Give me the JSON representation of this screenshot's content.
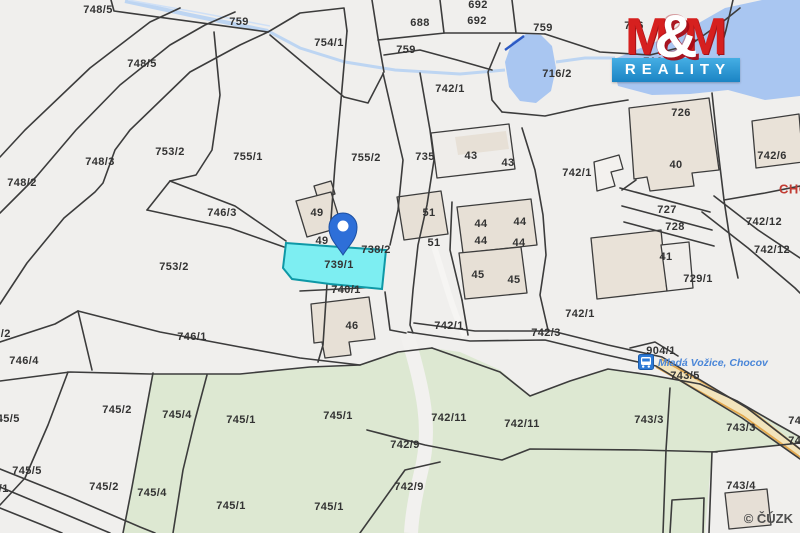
{
  "map": {
    "attribution": "© ČÚZK",
    "bus_stop": {
      "name": "Mladá Vožice, Chocov"
    },
    "place_name_red": "CHOCOV",
    "highlighted_parcel": "739/1",
    "colors": {
      "background": "#f0efed",
      "greenery": "#dde8d2",
      "water": "#a9c6f1",
      "stream": "#bdd5f2",
      "building": "#e7e0d6",
      "boundary_line": "#3c3c3c",
      "highlight_fill": "#7deef2",
      "highlight_border": "#0e98a6",
      "road_stripe": "#e3a84e",
      "pin_blue": "#2e6fd8",
      "bus_stop_blue": "#2d7ad6",
      "place_text_blue": "#4a86d8",
      "place_name_red": "#c23b33"
    },
    "parcel_labels": [
      {
        "t": "748/5",
        "x": 98,
        "y": 10
      },
      {
        "t": "759",
        "x": 239,
        "y": 22
      },
      {
        "t": "754/1",
        "x": 329,
        "y": 43
      },
      {
        "t": "759",
        "x": 406,
        "y": 50
      },
      {
        "t": "688",
        "x": 420,
        "y": 23
      },
      {
        "t": "692",
        "x": 478,
        "y": 5
      },
      {
        "t": "692",
        "x": 477,
        "y": 21
      },
      {
        "t": "748/5",
        "x": 142,
        "y": 64
      },
      {
        "t": "759",
        "x": 543,
        "y": 28
      },
      {
        "t": "716/2",
        "x": 557,
        "y": 74
      },
      {
        "t": "742/1",
        "x": 450,
        "y": 89
      },
      {
        "t": "716",
        "x": 634,
        "y": 26
      },
      {
        "t": "716/1",
        "x": 658,
        "y": 62
      },
      {
        "t": "726",
        "x": 681,
        "y": 113
      },
      {
        "t": "40",
        "x": 676,
        "y": 165
      },
      {
        "t": "742/6",
        "x": 772,
        "y": 156
      },
      {
        "t": "753/2",
        "x": 170,
        "y": 152
      },
      {
        "t": "755/1",
        "x": 248,
        "y": 157
      },
      {
        "t": "748/3",
        "x": 100,
        "y": 162
      },
      {
        "t": "748/2",
        "x": 22,
        "y": 183
      },
      {
        "t": "755/2",
        "x": 366,
        "y": 158
      },
      {
        "t": "735",
        "x": 425,
        "y": 157
      },
      {
        "t": "43",
        "x": 471,
        "y": 156
      },
      {
        "t": "43",
        "x": 508,
        "y": 163
      },
      {
        "t": "746/3",
        "x": 222,
        "y": 213
      },
      {
        "t": "753/2",
        "x": 174,
        "y": 267
      },
      {
        "t": "742/1",
        "x": 577,
        "y": 173
      },
      {
        "t": "727",
        "x": 667,
        "y": 210
      },
      {
        "t": "728",
        "x": 675,
        "y": 227
      },
      {
        "t": "41",
        "x": 666,
        "y": 257
      },
      {
        "t": "729/1",
        "x": 698,
        "y": 279
      },
      {
        "t": "742/12",
        "x": 764,
        "y": 222
      },
      {
        "t": "742/12",
        "x": 772,
        "y": 250
      },
      {
        "t": "CHOCOV",
        "x": 779,
        "y": 189,
        "cls": "red"
      },
      {
        "t": "49",
        "x": 317,
        "y": 213
      },
      {
        "t": "49",
        "x": 322,
        "y": 241
      },
      {
        "t": "738/2",
        "x": 376,
        "y": 250
      },
      {
        "t": "739/1",
        "x": 339,
        "y": 265
      },
      {
        "t": "740/1",
        "x": 346,
        "y": 290
      },
      {
        "t": "51",
        "x": 429,
        "y": 213
      },
      {
        "t": "51",
        "x": 434,
        "y": 243
      },
      {
        "t": "44",
        "x": 481,
        "y": 224
      },
      {
        "t": "44",
        "x": 520,
        "y": 222
      },
      {
        "t": "44",
        "x": 481,
        "y": 241
      },
      {
        "t": "44",
        "x": 519,
        "y": 243
      },
      {
        "t": "45",
        "x": 478,
        "y": 275
      },
      {
        "t": "45",
        "x": 514,
        "y": 280
      },
      {
        "t": "46",
        "x": 352,
        "y": 326
      },
      {
        "t": "742/1",
        "x": 449,
        "y": 326
      },
      {
        "t": "742/1",
        "x": 580,
        "y": 314
      },
      {
        "t": "742/3",
        "x": 546,
        "y": 333
      },
      {
        "t": "746/2",
        "x": -4,
        "y": 334
      },
      {
        "t": "746/4",
        "x": 24,
        "y": 361
      },
      {
        "t": "746/1",
        "x": 192,
        "y": 337
      },
      {
        "t": "745/5",
        "x": 5,
        "y": 419
      },
      {
        "t": "745/2",
        "x": 117,
        "y": 410
      },
      {
        "t": "745/4",
        "x": 177,
        "y": 415
      },
      {
        "t": "745/1",
        "x": 241,
        "y": 420
      },
      {
        "t": "745/5",
        "x": 27,
        "y": 471
      },
      {
        "t": "747/1",
        "x": -6,
        "y": 489
      },
      {
        "t": "745/2",
        "x": 104,
        "y": 487
      },
      {
        "t": "745/4",
        "x": 152,
        "y": 493
      },
      {
        "t": "745/1",
        "x": 231,
        "y": 506
      },
      {
        "t": "745/1",
        "x": 338,
        "y": 416
      },
      {
        "t": "742/11",
        "x": 449,
        "y": 418
      },
      {
        "t": "742/11",
        "x": 522,
        "y": 424
      },
      {
        "t": "742/9",
        "x": 405,
        "y": 445
      },
      {
        "t": "742/9",
        "x": 409,
        "y": 487
      },
      {
        "t": "745/1",
        "x": 329,
        "y": 507
      },
      {
        "t": "904/1",
        "x": 661,
        "y": 351
      },
      {
        "t": "743/5",
        "x": 685,
        "y": 376
      },
      {
        "t": "743/3",
        "x": 649,
        "y": 420
      },
      {
        "t": "743/3",
        "x": 741,
        "y": 428
      },
      {
        "t": "743/3",
        "x": 803,
        "y": 421
      },
      {
        "t": "743/1",
        "x": 803,
        "y": 441
      },
      {
        "t": "743/4",
        "x": 741,
        "y": 486
      }
    ]
  },
  "logo": {
    "m1": "M",
    "amp": "&",
    "m2": "M",
    "line2": "REALITY",
    "red": "#d6201f",
    "blue": "#1b84c4"
  }
}
